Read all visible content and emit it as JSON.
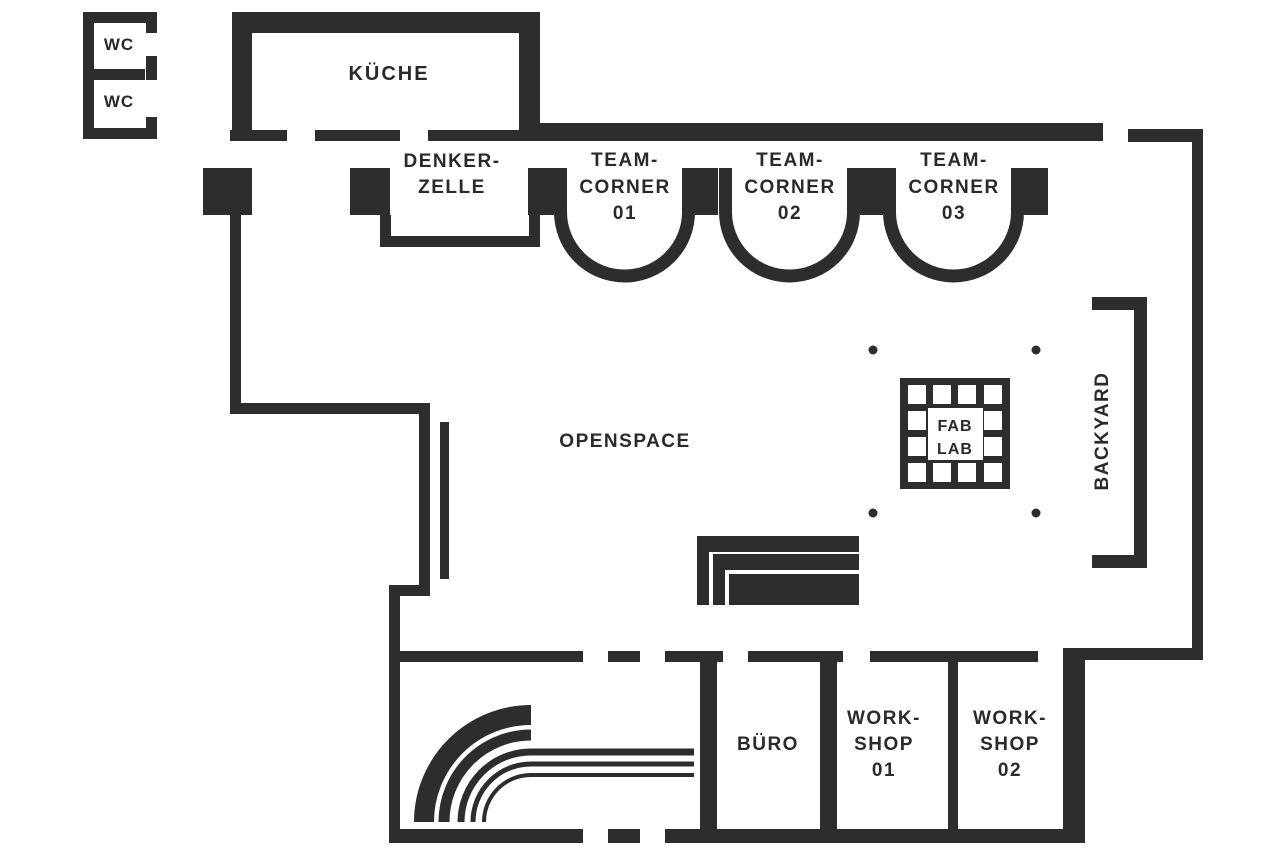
{
  "floorplan": {
    "colors": {
      "wall": "#2e2d2c",
      "background": "#ffffff",
      "text": "#2b2a29"
    },
    "labels": {
      "wc_top": "WC",
      "wc_bottom": "WC",
      "kitchen": "KÜCHE",
      "denkerzelle": {
        "line1": "DENKER-",
        "line2": "ZELLE"
      },
      "teamcorner01": {
        "line1": "TEAM-",
        "line2": "CORNER",
        "line3": "01"
      },
      "teamcorner02": {
        "line1": "TEAM-",
        "line2": "CORNER",
        "line3": "02"
      },
      "teamcorner03": {
        "line1": "TEAM-",
        "line2": "CORNER",
        "line3": "03"
      },
      "openspace": "OPENSPACE",
      "fablab": {
        "line1": "FAB",
        "line2": "LAB"
      },
      "backyard": "BACKYARD",
      "office": "BÜRO",
      "workshop01": {
        "line1": "WORK-",
        "line2": "SHOP",
        "line3": "01"
      },
      "workshop02": {
        "line1": "WORK-",
        "line2": "SHOP",
        "line3": "02"
      }
    }
  }
}
